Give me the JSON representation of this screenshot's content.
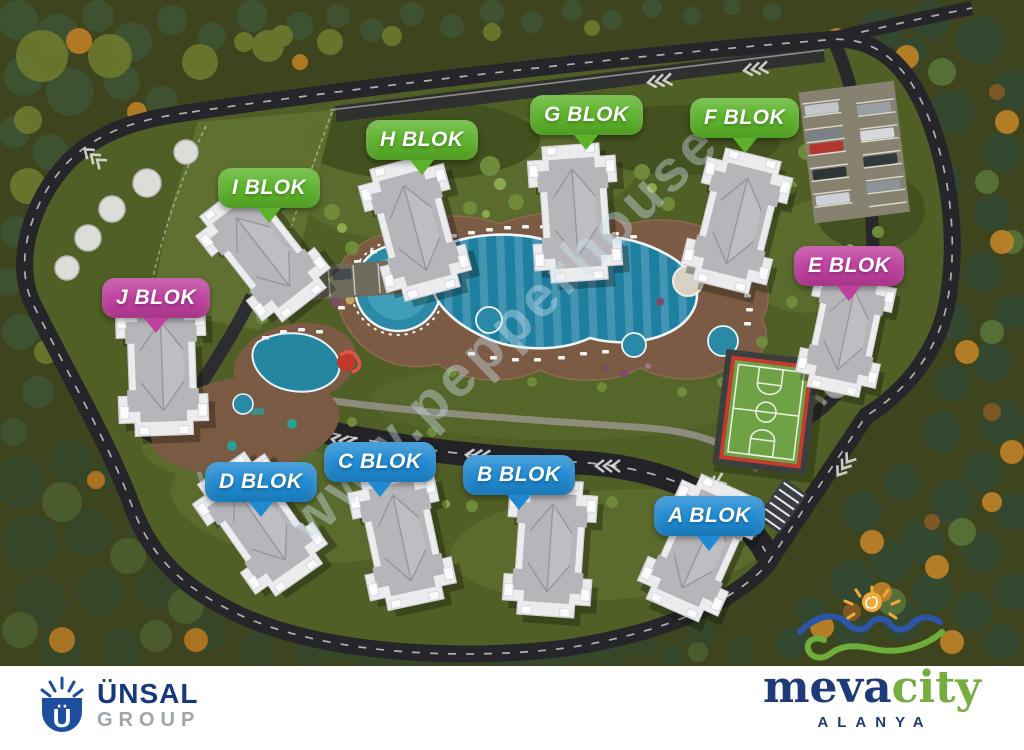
{
  "site": {
    "watermark": "www.pepperhouse"
  },
  "blocks": [
    {
      "id": "I",
      "label": "I BLOK",
      "color": "#5cb32a"
    },
    {
      "id": "H",
      "label": "H BLOK",
      "color": "#5cb32a"
    },
    {
      "id": "G",
      "label": "G BLOK",
      "color": "#5cb32a"
    },
    {
      "id": "F",
      "label": "F BLOK",
      "color": "#5cb32a"
    },
    {
      "id": "E",
      "label": "E BLOK",
      "color": "#bf3f9e"
    },
    {
      "id": "J",
      "label": "J BLOK",
      "color": "#bf3f9e"
    },
    {
      "id": "D",
      "label": "D BLOK",
      "color": "#1f8ad2"
    },
    {
      "id": "C",
      "label": "C BLOK",
      "color": "#1f8ad2"
    },
    {
      "id": "B",
      "label": "B BLOK",
      "color": "#1f8ad2"
    },
    {
      "id": "A",
      "label": "A BLOK",
      "color": "#1f8ad2"
    }
  ],
  "footer": {
    "unsal": {
      "name": "ÜNSAL",
      "group": "GROUP"
    },
    "meva": {
      "word_main": "meva",
      "word_accent": "city",
      "subtitle": "ALANYA"
    }
  },
  "colors": {
    "block_green": "#5cb32a",
    "block_blue": "#1f8ad2",
    "block_magenta": "#bf3f9e",
    "navy": "#16387e",
    "logo_green": "#76ad3f",
    "logo_grey": "#a0a5ab"
  }
}
